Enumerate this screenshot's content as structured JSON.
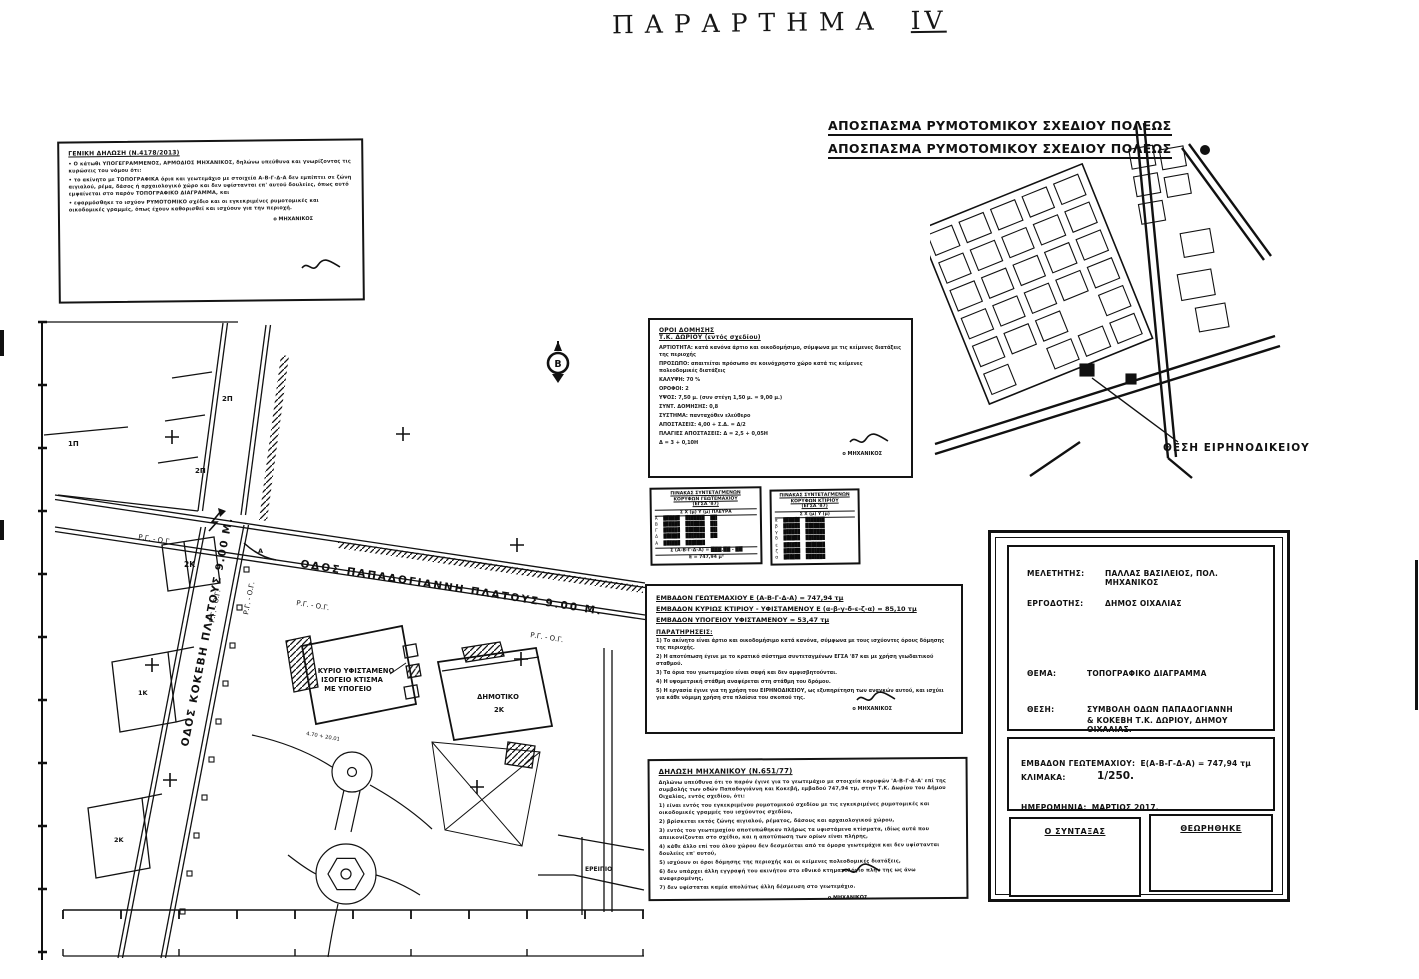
{
  "handwritten_title": {
    "word": "ΠΑΡΑΡΤΗΜΑ",
    "numeral": "IV"
  },
  "excerpt": {
    "heading_line1": "ΑΠΟΣΠΑΣΜΑ ΡΥΜΟΤΟΜΙΚΟΥ ΣΧΕΔΙΟΥ ΠΟΛΕΩΣ",
    "heading_line2": "ΑΠΟΣΠΑΣΜΑ ΡΥΜΟΤΟΜΙΚΟΥ ΣΧΕΔΙΟΥ ΠΟΛΕΩΣ",
    "callout": "ΘΕΣΗ ΕΙΡΗΝΟΔΙΚΕΙΟΥ"
  },
  "notes_box": {
    "heading": "ΓΕΝΙΚΗ ΔΗΛΩΣΗ (Ν.4178/2013)",
    "lines": [
      "• Ο κάτωθι ΥΠΟΓΕΓΡΑΜΜΕΝΟΣ, ΑΡΜΟΔΙΟΣ ΜΗΧΑΝΙΚΟΣ, δηλώνω υπεύθυνα και γνωρίζοντας τις κυρώσεις του νόμου ότι:",
      "•  το ακίνητο με ΤΟΠΟΓΡΑΦΙΚΑ όρια και γεωτεμάχιο με στοιχεία Α-Β-Γ-Δ-Α δεν εμπίπτει σε ζώνη αιγιαλού, ρέμα, δάσος ή αρχαιολογικό χώρο και δεν υφίστανται επ' αυτού δουλείες, όπως αυτό εμφαίνεται στο παρόν ΤΟΠΟΓΡΑΦΙΚΟ ΔΙΑΓΡΑΜΜΑ, και",
      "•  εφαρμόσθηκε το ισχύον ΡΥΜΟΤΟΜΙΚΟ σχέδιο και οι εγκεκριμένες ρυμοτομικές και οικοδομικές γραμμές, όπως έχουν καθορισθεί και ισχύουν για την περιοχή."
    ],
    "signature": "ο ΜΗΧΑΝΙΚΟΣ"
  },
  "terms_box": {
    "heading1": "ΟΡΟΙ ΔΟΜΗΣΗΣ",
    "heading2": "Τ.Κ. ΔΩΡΙΟΥ (εντός σχεδίου)",
    "lines": [
      "ΑΡΤΙΟΤΗΤΑ:  κατά κανόνα άρτιο και οικοδομήσιμο, σύμφωνα με τις κείμενες διατάξεις της περιοχής",
      "ΠΡΟΣΩΠΟ:  απαιτείται πρόσωπο σε κοινόχρηστο χώρο κατά τις κείμενες πολεοδομικές διατάξεις",
      "ΚΑΛΥΨΗ:  70 %",
      "ΟΡΟΦΟΙ:  2",
      "ΥΨΟΣ:  7,50 μ. (συν στέγη 1,50 μ. = 9,00 μ.)",
      "ΣΥΝΤ. ΔΟΜΗΣΗΣ:  0,8",
      "ΣΥΣΤΗΜΑ:  πανταχόθεν ελεύθερο",
      "ΑΠΟΣΤΑΣΕΙΣ:  4,00 + Σ.Δ. = Δ/2",
      "ΠΛΑΓΙΕΣ ΑΠΟΣΤΑΣΕΙΣ:  Δ = 2,5 + 0,05Η",
      "                                Δ = 3 + 0,10Η"
    ],
    "signature": "ο ΜΗΧΑΝΙΚΟΣ"
  },
  "coord_tables": {
    "left": {
      "title": [
        "ΠΙΝΑΚΑΣ ΣΥΝΤΕΤΑΓΜΕΝΩΝ",
        "ΚΟΡΥΦΩΝ ΓΕΩΤΕΜΑΧΙΟΥ",
        "(ΕΓΣΑ '87)"
      ],
      "header": "Σ      Χ (μ)       Υ (μ)    ΠΛΕΥΡΑ",
      "rows": [
        "Α  ██████  ███████  ██▌",
        "Β  ██████  ███████  ██▌",
        "Γ  ██████  ███████  ██▌",
        "Δ  ██████  ███████  ██▌",
        "Α  ██████  ███████"
      ],
      "footer": [
        "Σ (Α-Β-Γ-Δ-Α) = ███,██ - ██",
        "Ε = 747,94 μ²"
      ]
    },
    "right": {
      "title": [
        "ΠΙΝΑΚΑΣ ΣΥΝΤΕΤΑΓΜΕΝΩΝ",
        "ΚΟΡΥΦΩΝ ΚΤΙΡΙΟΥ",
        "(ΕΓΣΑ '87)"
      ],
      "header": "Σ      Χ (μ)       Υ (μ)",
      "rows": [
        "α  ██████  ███████",
        "β  ██████  ███████",
        "γ  ██████  ███████",
        "δ  ██████  ███████",
        "ε  ██████  ███████",
        "ζ  ██████  ███████",
        "α  ██████  ███████"
      ]
    }
  },
  "areas_box": {
    "underlined": [
      "ΕΜΒΑΔΟΝ ΓΕΩΤΕΜΑΧΙΟΥ          Ε (Α-Β-Γ-Δ-Α) = 747,94 τμ",
      "ΕΜΒΑΔΟΝ ΚΥΡΙΩΣ ΚΤΙΡΙΟΥ - ΥΦΙΣΤΑΜΕΝΟΥ   Ε (α-β-γ-δ-ε-ζ-α) = 85,10 τμ",
      "ΕΜΒΑΔΟΝ ΥΠΟΓΕΙΟΥ ΥΦΙΣΤΑΜΕΝΟΥ  = 53,47 τμ"
    ],
    "notes_heading": "ΠΑΡΑΤΗΡΗΣΕΙΣ:",
    "notes": [
      "1) Το ακίνητο είναι άρτιο και οικοδομήσιμο κατά κανόνα, σύμφωνα με τους ισχύοντες όρους δόμησης της περιοχής.",
      "2) Η αποτύπωση έγινε με το κρατικό σύστημα συντεταγμένων ΕΓΣΑ '87 και με χρήση γεωδαιτικού σταθμού.",
      "3) Τα όρια του γεωτεμαχίου είναι σαφή και δεν αμφισβητούνται.",
      "4) Η υψομετρική στάθμη αναφέρεται στη στάθμη του δρόμου.",
      "5) Η εργασία έγινε για τη χρήση του ΕΙΡΗΝΟΔΙΚΕΙΟΥ, ως εξυπηρέτηση των αναγκών αυτού, και ισχύει για κάθε νόμιμη χρήση στα πλαίσια του σκοπού της."
    ],
    "signature": "ο ΜΗΧΑΝΙΚΟΣ"
  },
  "declaration_box": {
    "heading": "ΔΗΛΩΣΗ ΜΗΧΑΝΙΚΟΥ (Ν.651/77)",
    "lines": [
      "Δηλώνω υπεύθυνα ότι το παρόν έγινε για το γεωτεμάχιο με στοιχεία κορυφών 'Α-Β-Γ-Δ-Α' επί της συμβολής των οδών Παπαδογιάννη και Κοκεβή, εμβαδού 747,94 τμ, στην Τ.Κ. Δωρίου του Δήμου Οιχαλίας, εντός σχεδίου, ότι:",
      "1)  είναι εντός του εγκεκριμένου ρυμοτομικού σχεδίου με τις εγκεκριμένες ρυμοτομικές και οικοδομικές γραμμές του ισχύοντος σχεδίου,",
      "2)  βρίσκεται εκτός ζώνης αιγιαλού, ρέματος, δάσους και αρχαιολογικού χώρου,",
      "3)  εντός του γεωτεμαχίου αποτυπώθηκαν πλήρως τα υφιστάμενα κτίσματα, ιδίως αυτά που απεικονίζονται στο σχέδιο, και η αποτύπωση των ορίων είναι πλήρης,",
      "4)  κάθε άλλο επί του όλου χώρου δεν δεσμεύεται από τα όμορα γεωτεμάχια και δεν υφίστανται δουλείες επ' αυτού,",
      "5)  ισχύουν οι όροι δόμησης της περιοχής και οι κείμενες πολεοδομικές διατάξεις,",
      "6)  δεν υπάρχει άλλη εγγραφή του ακινήτου στο εθνικό κτηματολόγιο πλην της ως άνω αναφερομένης,",
      "7)  δεν υφίσταται καμία απολύτως άλλη δέσμευση στο γεωτεμάχιο."
    ],
    "signature": "ο ΜΗΧΑΝΙΚΟΣ"
  },
  "title_block": {
    "meletitis_label": "ΜΕΛΕΤΗΤΗΣ:",
    "meletitis_value": "ΠΑΛΛΑΣ ΒΑΣΙΛΕΙΟΣ, ΠΟΛ. ΜΗΧΑΝΙΚΟΣ",
    "ergodotis_label": "ΕΡΓΟΔΟΤΗΣ:",
    "ergodotis_value": "ΔΗΜΟΣ ΟΙΧΑΛΙΑΣ",
    "thema_label": "ΘΕΜΑ:",
    "thema_value": "ΤΟΠΟΓΡΑΦΙΚΟ ΔΙΑΓΡΑΜΜΑ",
    "thesi_label": "ΘΕΣΗ:",
    "thesi_value1": "ΣΥΜΒΟΛΗ ΟΔΩΝ ΠΑΠΑΔΟΓΙΑΝΝΗ",
    "thesi_value2": "& ΚΟΚΕΒΗ Τ.Κ. ΔΩΡΙΟΥ, ΔΗΜΟΥ ΟΙΧΑΛΙΑΣ.",
    "area_label": "ΕΜΒΑΔΟΝ ΓΕΩΤΕΜΑΧΙΟΥ:",
    "area_value": "Ε(Α-Β-Γ-Δ-Α) = 747,94 τμ",
    "scale_label": "ΚΛΙΜΑΚΑ:",
    "scale_value": "1/250.",
    "date_label": "ΗΜΕΡΟΜΗΝΙΑ:",
    "date_value": "ΜΑΡΤΙΟΣ 2017.",
    "sign_left": "Ο ΣΥΝΤΑΞΑΣ",
    "sign_right": "ΘΕΩΡΗΘΗΚΕ"
  },
  "plan": {
    "street1": "ΟΔΟΣ ΠΑΠΑΔΟΓΙΑΝΝΗ  ΠΛΑΤΟΥΣ 9.00 Μ.",
    "street2": "ΟΔΟΣ ΚΟΚΕΒΗ ΠΛΑΤΟΥΣ 9.00 Μ.",
    "rg_og": "Ρ.Γ. - Ο.Γ.",
    "north_letter": "Β",
    "building_main_1": "ΚΥΡΙΟ ΥΦΙΣΤΑΜΕΝΟ",
    "building_main_2": "ΙΣΟΓΕΙΟ ΚΤΙΣΜΑ",
    "building_main_3": "ΜΕ ΥΠΟΓΕΙΟ",
    "building2_1": "ΔΗΜΟΤΙΚΟ",
    "building2_2": "2Κ",
    "ruin": "ΕΡΕΙΠΙΟ",
    "parcel_p1": "2Π",
    "parcel_p2": "1Π",
    "parcel_p3": "2Π",
    "parcel_k1": "2Κ",
    "parcel_k2": "1Κ",
    "parcel_k3": "2Κ",
    "vertex_a": "Α",
    "dim1": "4.70 + 20.01"
  },
  "colors": {
    "ink": "#111111",
    "paper": "#ffffff"
  }
}
